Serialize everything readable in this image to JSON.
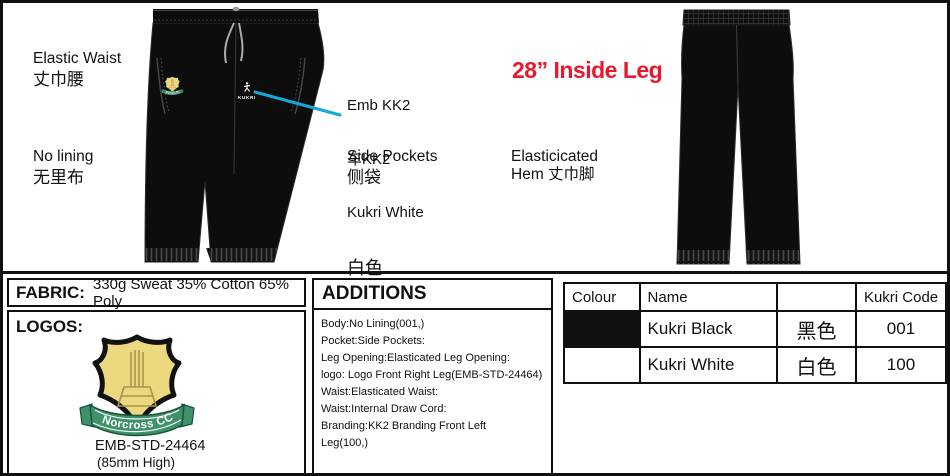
{
  "labels": {
    "elastic_waist_en": "Elastic Waist",
    "elastic_waist_zh": "丈巾腰",
    "no_lining_en": "No lining",
    "no_lining_zh": "无里布",
    "emb_line1": "Emb KK2",
    "emb_line2": "车KK2",
    "emb_line3": "Kukri White",
    "emb_line4": "白色",
    "side_pockets_en": "Side Pockets",
    "side_pockets_zh": "侧袋",
    "inside_leg": "28” Inside Leg",
    "hem_line1": "Elasticicated",
    "hem_line2": "Hem 丈巾脚"
  },
  "fabric": {
    "label": "FABRIC:",
    "value": "330g Sweat 35% Cotton 65% Poly"
  },
  "logos": {
    "label": "LOGOS:",
    "badge_text": "Norcross CC",
    "code": "EMB-STD-24464",
    "size": "(85mm  High)"
  },
  "additions": {
    "title": "ADDITIONS",
    "items": [
      "Body:No Lining(001,)",
      "Pocket:Side Pockets:",
      "Leg Opening:Elasticated Leg Opening:",
      "logo: Logo Front Right Leg(EMB-STD-24464)",
      "Waist:Elasticated Waist:",
      "Waist:Internal Draw Cord:",
      "Branding:KK2 Branding Front Left\nLeg(100,)"
    ]
  },
  "colour_table": {
    "headers": [
      "Colour",
      "Name",
      "",
      "Kukri Code"
    ],
    "rows": [
      {
        "swatch": "#111111",
        "name": "Kukri Black",
        "zh": "黑色",
        "code": "001"
      },
      {
        "swatch": "#ffffff",
        "name": "Kukri White",
        "zh": "白色",
        "code": "100"
      }
    ]
  },
  "garment": {
    "brand": "KUKRI"
  },
  "colors": {
    "callout_red": "#e8182d",
    "annotation_line_blue": "#17a6d8",
    "pants_black": "#0d0d0d",
    "badge_yellow": "#ecd87e",
    "ribbon_green": "#3f9169"
  }
}
